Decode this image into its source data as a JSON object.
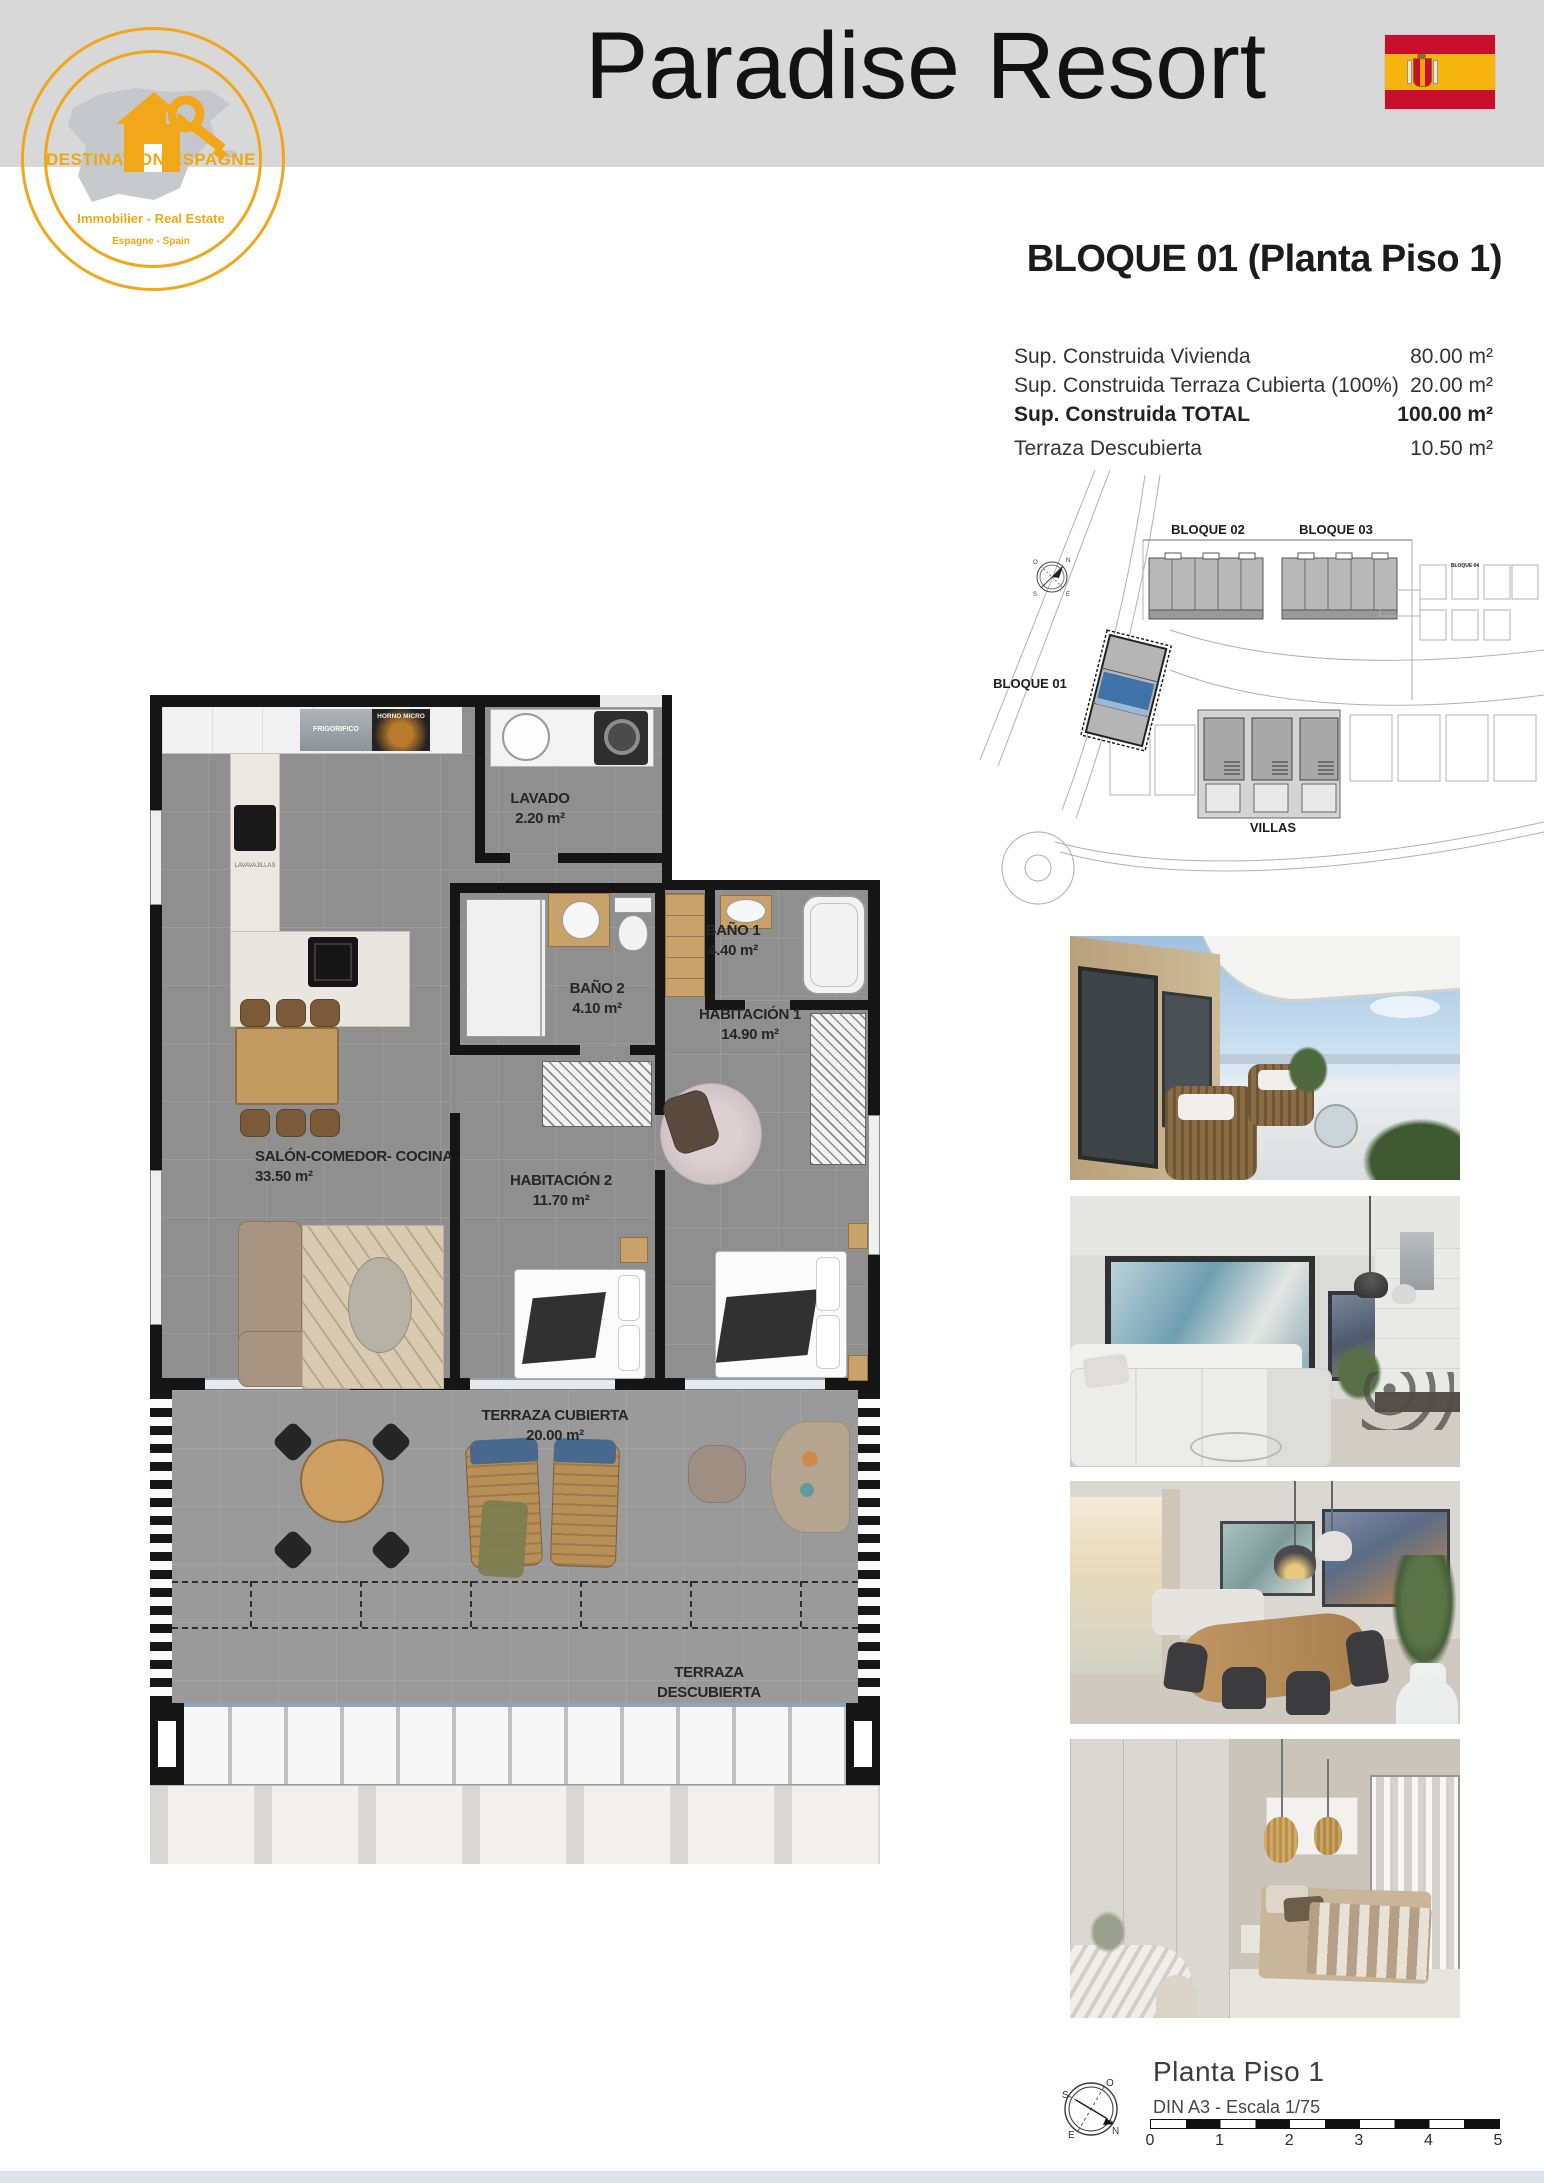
{
  "header": {
    "title": "Paradise Resort",
    "logo": {
      "brand": "DESTINATION ESPAGNE",
      "tagline": "Immobilier - Real Estate",
      "subtagline": "Espagne - Spain"
    }
  },
  "plan_heading": "BLOQUE 01  (Planta Piso 1)",
  "surface_table": {
    "rows": [
      {
        "label": "Sup. Construida Vivienda",
        "value": "80.00 m²"
      },
      {
        "label": "Sup. Construida Terraza Cubierta (100%)",
        "value": "20.00 m²"
      },
      {
        "label": "Sup. Construida TOTAL",
        "value": "100.00 m²"
      },
      {
        "label": "Terraza Descubierta",
        "value": "10.50 m²"
      }
    ]
  },
  "site_plan": {
    "bloque01": "BLOQUE 01",
    "bloque02": "BLOQUE 02",
    "bloque03": "BLOQUE 03",
    "bloque04": "BLOQUE 04",
    "villas": "VILLAS",
    "highlight_color": "#3f72a8"
  },
  "floor_plan": {
    "rooms": [
      {
        "name": "LAVADO",
        "area": "2.20 m²"
      },
      {
        "name": "BAÑO 2",
        "area": "4.10 m²"
      },
      {
        "name": "BAÑO 1",
        "area": "4.40 m²"
      },
      {
        "name": "HABITACIÓN 1",
        "area": "14.90 m²"
      },
      {
        "name": "HABITACIÓN 2",
        "area": "11.70 m²"
      },
      {
        "name": "SALÓN-COMEDOR- COCINA",
        "area": "33.50 m²"
      },
      {
        "name": "TERRAZA CUBIERTA",
        "area": "20.00 m²"
      },
      {
        "name": "TERRAZA DESCUBIERTA",
        "area": "10.50 m²"
      }
    ],
    "appliances": {
      "fridge": "FRIGORIFICO",
      "oven": "HORNO MICRO",
      "dishwasher": "LAVAVAJILLAS"
    }
  },
  "footer": {
    "title": "Planta Piso 1",
    "subtitle": "DIN A3 - Escala 1/75",
    "scale_ticks": [
      "0",
      "1",
      "2",
      "3",
      "4",
      "5"
    ],
    "compass": {
      "n": "N",
      "s": "S",
      "e": "E",
      "o": "O"
    }
  }
}
